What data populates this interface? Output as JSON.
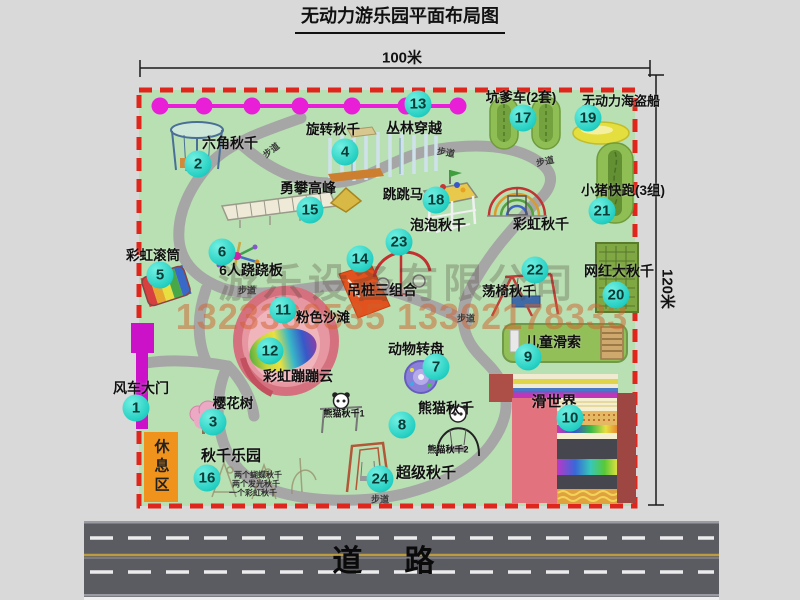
{
  "title": "无动力游乐园平面布局图",
  "dimensions": {
    "width_label": "100米",
    "height_label": "120米"
  },
  "road_label": "道路",
  "rest_area_label": "休息区",
  "walkway_label": "步道",
  "watermark": {
    "company": "游乐设备有限公司",
    "phone": "1323380535 13302178333"
  },
  "walkways": [
    {
      "x": 271,
      "y": 150,
      "r": -38
    },
    {
      "x": 446,
      "y": 152,
      "r": 10
    },
    {
      "x": 545,
      "y": 161,
      "r": -12
    },
    {
      "x": 247,
      "y": 290,
      "r": 0
    },
    {
      "x": 466,
      "y": 318,
      "r": 0
    },
    {
      "x": 380,
      "y": 499,
      "r": 0
    }
  ],
  "attractions": [
    {
      "n": "1",
      "label": "风车大门",
      "lx": 141,
      "ly": 388,
      "ls": 14,
      "bx": 136,
      "by": 408
    },
    {
      "n": "2",
      "label": "六角秋千",
      "lx": 230,
      "ly": 143,
      "ls": 14,
      "bx": 198,
      "by": 164
    },
    {
      "n": "3",
      "label": "樱花树",
      "lx": 233,
      "ly": 402,
      "ls": 13.5,
      "bx": 213,
      "by": 422
    },
    {
      "n": "4",
      "label": "旋转秋千",
      "lx": 333,
      "ly": 128,
      "ls": 13.5,
      "bx": 345,
      "by": 152
    },
    {
      "n": "5",
      "label": "彩虹滚筒",
      "lx": 153,
      "ly": 254,
      "ls": 13.5,
      "bx": 160,
      "by": 275
    },
    {
      "n": "6",
      "label": "6人跷跷板",
      "lx": 251,
      "ly": 270,
      "ls": 14,
      "bx": 222,
      "by": 252
    },
    {
      "n": "7",
      "label": "动物转盘",
      "lx": 416,
      "ly": 349,
      "ls": 14,
      "bx": 436,
      "by": 367
    },
    {
      "n": "8",
      "label": "熊猫秋千",
      "lx": 446,
      "ly": 408,
      "ls": 14,
      "bx": 402,
      "by": 425
    },
    {
      "n": "9",
      "label": "儿童滑索",
      "lx": 553,
      "ly": 342,
      "ls": 14,
      "bx": 528,
      "by": 357
    },
    {
      "n": "10",
      "label": "滑世界",
      "lx": 554,
      "ly": 401,
      "ls": 15,
      "bx": 570,
      "by": 418
    },
    {
      "n": "11",
      "label": "粉色沙滩",
      "lx": 323,
      "ly": 316,
      "ls": 13.5,
      "bx": 283,
      "by": 310
    },
    {
      "n": "12",
      "label": "彩虹蹦蹦云",
      "lx": 298,
      "ly": 376,
      "ls": 14,
      "bx": 270,
      "by": 351
    },
    {
      "n": "13",
      "label": "丛林穿越",
      "lx": 414,
      "ly": 128,
      "ls": 14,
      "bx": 418,
      "by": 104
    },
    {
      "n": "14",
      "label": "吊桩三组合",
      "lx": 382,
      "ly": 290,
      "ls": 14,
      "bx": 360,
      "by": 259
    },
    {
      "n": "15",
      "label": "勇攀高峰",
      "lx": 308,
      "ly": 188,
      "ls": 14,
      "bx": 310,
      "by": 210
    },
    {
      "n": "16",
      "label": "秋千乐园",
      "lx": 231,
      "ly": 455,
      "ls": 15,
      "bx": 207,
      "by": 478
    },
    {
      "n": "17",
      "label": "坑爹车(2套)",
      "lx": 521,
      "ly": 96,
      "ls": 13.5,
      "bx": 523,
      "by": 118
    },
    {
      "n": "18",
      "label": "跳跳马",
      "lx": 403,
      "ly": 193,
      "ls": 13.5,
      "bx": 436,
      "by": 200
    },
    {
      "n": "19",
      "label": "无动力海盗船",
      "lx": 621,
      "ly": 100,
      "ls": 13,
      "bx": 588,
      "by": 118
    },
    {
      "n": "20",
      "label": "网红大秋千",
      "lx": 619,
      "ly": 271,
      "ls": 14,
      "bx": 616,
      "by": 295
    },
    {
      "n": "21",
      "label": "小猪快跑(3组)",
      "lx": 623,
      "ly": 189,
      "ls": 13.5,
      "bx": 602,
      "by": 211
    },
    {
      "n": "22",
      "label": "荡椅秋千",
      "lx": 509,
      "ly": 290,
      "ls": 13.5,
      "bx": 535,
      "by": 270
    },
    {
      "n": "23",
      "label": "泡泡秋千",
      "lx": 438,
      "ly": 225,
      "ls": 14,
      "bx": 399,
      "by": 242
    },
    {
      "n": "24",
      "label": "超级秋千",
      "lx": 426,
      "ly": 472,
      "ls": 15,
      "bx": 380,
      "by": 479
    },
    {
      "n": null,
      "label": "彩虹秋千",
      "lx": 541,
      "ly": 224,
      "ls": 14,
      "bx": null,
      "by": null
    },
    {
      "n": null,
      "label": "熊猫秋千1",
      "lx": 344,
      "ly": 413,
      "ls": 9,
      "bx": null,
      "by": null
    },
    {
      "n": null,
      "label": "熊猫秋千2",
      "lx": 448,
      "ly": 449,
      "ls": 9,
      "bx": null,
      "by": null
    }
  ],
  "swing_park_notes": [
    {
      "text": "两个蝴蝶秋千",
      "x": 258,
      "y": 475
    },
    {
      "text": "两个发光秋千",
      "x": 256,
      "y": 484
    },
    {
      "text": "一个彩虹秋千",
      "x": 253,
      "y": 493
    }
  ]
}
